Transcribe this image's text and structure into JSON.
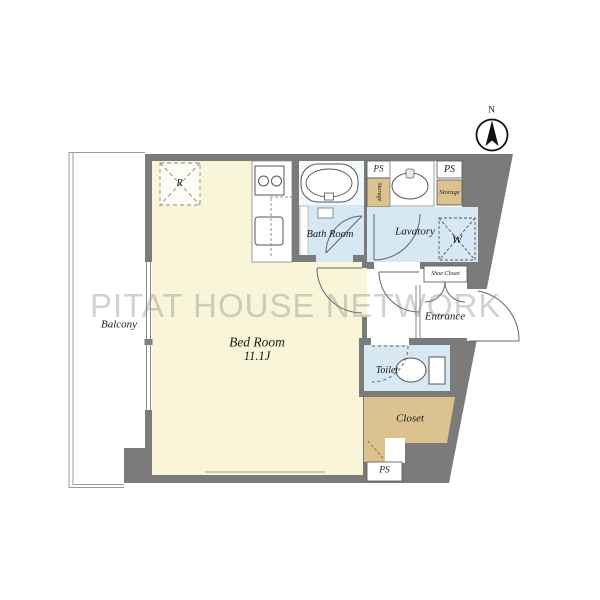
{
  "watermark": {
    "text": "PITAT HOUSE NETWORK"
  },
  "compass": {
    "north": "N"
  },
  "rooms": {
    "bedroom": {
      "label": "Bed Room",
      "area": "11.1J"
    },
    "balcony": {
      "label": "Balcony"
    },
    "bathroom": {
      "label": "Bath Room"
    },
    "lavatory": {
      "label": "Lavatory"
    },
    "toilet": {
      "label": "Toilet"
    },
    "entrance": {
      "label": "Entrance"
    },
    "closet": {
      "label": "Closet"
    },
    "shoe_closet": {
      "label": "Shoe Closet"
    }
  },
  "fixtures": {
    "refrigerator": "R",
    "washer": "W"
  },
  "utility": {
    "ps_top_left": "PS",
    "storage_left": "Storage",
    "ps_top_right": "PS",
    "storage_right": "Storage",
    "ps_bottom": "PS"
  },
  "colors": {
    "wall": "#7b7b7b",
    "room_cream": "#f8f5d9",
    "wet_blue": "#d6e8f3",
    "storage_tan": "#dbc28e",
    "watermark_gray": "#c9c9c9"
  }
}
